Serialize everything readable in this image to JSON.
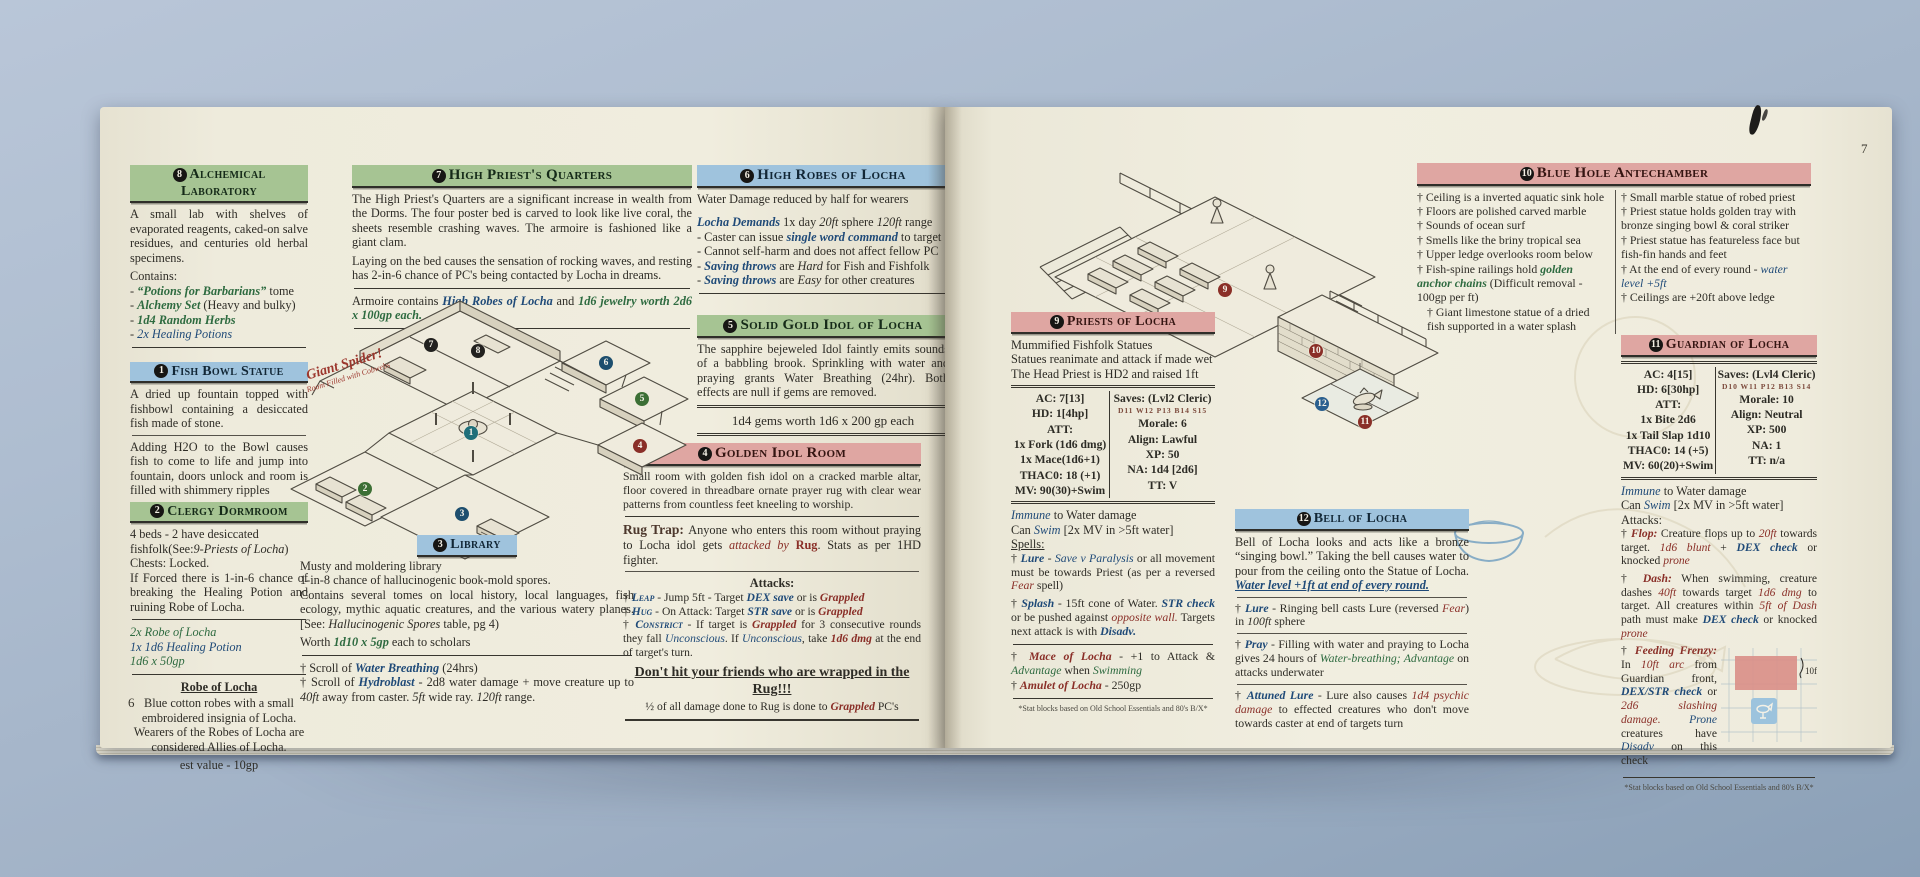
{
  "colors": {
    "header_green": "#a6c493",
    "header_blue": "#9fc3dd",
    "header_pink": "#dfa6a2",
    "accent_green": "#2e6b40",
    "accent_blue": "#1f4a78",
    "accent_red": "#8a2f28",
    "page": "#efecdd",
    "backdrop": "#a7b7cb"
  },
  "book": {
    "page6_number": "6",
    "page7_number": "7",
    "footnote": "*Stat blocks based on Old School Essentials and 80's B/X*"
  },
  "p6": {
    "alch": {
      "num": "8",
      "title": "Alchemical Laboratory",
      "body": "A small lab with shelves of evaporated reagents, caked-on salve residues, and centuries old herbal specimens.",
      "contains": "Contains:",
      "items": [
        [
          [
            "- ",
            "n"
          ],
          [
            "“Potions for Barbarians”",
            "g"
          ],
          [
            " tome",
            "n"
          ]
        ],
        [
          [
            "- ",
            "n"
          ],
          [
            "Alchemy Set",
            "g"
          ],
          [
            " (Heavy and bulky)",
            "n"
          ]
        ],
        [
          [
            "- ",
            "n"
          ],
          [
            "1d4 Random Herbs",
            "g"
          ]
        ],
        [
          [
            "- ",
            "n"
          ],
          [
            "2x Healing Potions",
            "bi"
          ]
        ]
      ]
    },
    "fish": {
      "num": "1",
      "title": "Fish Bowl Statue",
      "p1": "A dried up fountain topped with fishbowl containing a desiccated fish made of stone.",
      "p2": "Adding H2O to the Bowl causes fish to come to life and jump into fountain, doors unlock and room is filled with shimmery ripples"
    },
    "clergy": {
      "num": "2",
      "title": "Clergy Dormroom",
      "l1": [
        [
          "4 beds - 2 have desiccated fishfolk(See:",
          "n"
        ],
        [
          "9-Priests of Locha",
          "i"
        ],
        [
          ")",
          "n"
        ]
      ],
      "l2": "Chests: Locked.",
      "l3": "If Forced there is 1-in-6 chance of breaking the Healing Potion and ruining Robe of Locha.",
      "loot": [
        [
          [
            "2x Robe of Locha",
            "gi"
          ]
        ],
        [
          [
            "1x 1d6 Healing Potion",
            "bi"
          ]
        ],
        [
          [
            "1d6 x 50gp",
            "gi"
          ]
        ]
      ]
    },
    "robe": {
      "title": "Robe of Locha",
      "body": "Blue cotton robes with a small embroidered insignia of Locha. Wearers of the Robes of Locha are considered Allies of Locha.",
      "value": "est value - 10gp"
    },
    "hp": {
      "num": "7",
      "title": "High Priest's Quarters",
      "p1": "The High Priest's Quarters are a significant increase in wealth from the Dorms. The four poster bed is carved to look like live coral, the sheets resemble crashing waves. The armoire is fashioned like a giant clam.",
      "p2": "Laying on the bed causes the sensation of rocking waves, and resting has 2-in-6 chance of PC's being contacted by Locha in dreams.",
      "loot": [
        [
          "Armoire contains ",
          "n"
        ],
        [
          "High Robes of Locha",
          "b"
        ],
        [
          " and ",
          "n"
        ],
        [
          "1d6 jewelry worth 2d6 x 100gp each.",
          "g"
        ]
      ]
    },
    "robes6": {
      "num": "6",
      "title": "High Robes of Locha",
      "l1": "Water Damage reduced by half for wearers",
      "spell": [
        [
          "Locha Demands",
          "b"
        ],
        [
          " 1x day ",
          "n"
        ],
        [
          "20ft",
          "i"
        ],
        [
          " sphere ",
          "n"
        ],
        [
          "120ft",
          "i"
        ],
        [
          " range",
          "n"
        ]
      ],
      "b1": [
        [
          "- Caster can issue ",
          "n"
        ],
        [
          "single word command",
          "b"
        ],
        [
          " to target",
          "n"
        ]
      ],
      "b2": [
        [
          "- Cannot self-harm and does not affect fellow PC",
          "n"
        ]
      ],
      "b3": [
        [
          "- ",
          "n"
        ],
        [
          "Saving throws",
          "b"
        ],
        [
          " are ",
          "n"
        ],
        [
          "Hard",
          "i"
        ],
        [
          " for Fish and Fishfolk",
          "n"
        ]
      ],
      "b4": [
        [
          "- ",
          "n"
        ],
        [
          "Saving throws",
          "b"
        ],
        [
          " are ",
          "n"
        ],
        [
          "Easy",
          "i"
        ],
        [
          " for other creatures",
          "n"
        ]
      ]
    },
    "idol5": {
      "num": "5",
      "title": "Solid Gold Idol of Locha",
      "body": "The sapphire bejeweled Idol faintly emits sounds of a babbling brook.  Sprinkling with water and praying grants Water Breathing (24hr). Both effects are null if gems are removed.",
      "gems": "1d4 gems worth 1d6 x 200 gp each"
    },
    "lib": {
      "num": "3",
      "title": "Library",
      "l1": "Musty and  moldering library",
      "l2": "1-in-8 chance of hallucinogenic book-mold spores.",
      "l3": [
        [
          "Contains several tomes on local history, local languages, fish ecology, mythic aquatic creatures, and the various watery planes. [See: ",
          "n"
        ],
        [
          "Hallucinogenic Spores",
          "i"
        ],
        [
          " table, pg 4)",
          "n"
        ]
      ],
      "l4": [
        [
          "Worth ",
          "n"
        ],
        [
          "1d10 x 5gp",
          "g"
        ],
        [
          " each to scholars",
          "n"
        ]
      ],
      "s1": [
        [
          "†  Scroll of ",
          "n"
        ],
        [
          "Water Breathing",
          "b"
        ],
        [
          " (24hrs)",
          "n"
        ]
      ],
      "s2": [
        [
          "†  Scroll of ",
          "n"
        ],
        [
          "Hydroblast",
          "b"
        ],
        [
          " - 2d8 water damage + move creature up to ",
          "n"
        ],
        [
          "40ft",
          "i"
        ],
        [
          " away from caster. ",
          "n"
        ],
        [
          "5ft",
          "i"
        ],
        [
          " wide ray. ",
          "n"
        ],
        [
          "120ft",
          "i"
        ],
        [
          " range.",
          "n"
        ]
      ]
    },
    "room4": {
      "num": "4",
      "title": "Golden Idol Room",
      "body": "Small room with golden fish idol on a cracked marble altar, floor covered in threadbare ornate prayer rug with clear wear patterns from countless feet kneeling to worship.",
      "rug": [
        [
          "Rug Trap: ",
          "lbl"
        ],
        [
          "Anyone who enters this room without praying to Locha idol gets ",
          "n"
        ],
        [
          "attacked by ",
          "ri"
        ],
        [
          "Rug",
          "rb"
        ],
        [
          ". Stats as per 1HD fighter.",
          "n"
        ]
      ],
      "atk_label": "Attacks:",
      "a1": [
        [
          "†  ",
          "n"
        ],
        [
          "Leap",
          "bsc"
        ],
        [
          " - Jump 5ft - Target ",
          "n"
        ],
        [
          "DEX save",
          "b"
        ],
        [
          " or is ",
          "n"
        ],
        [
          "Grappled",
          "r"
        ]
      ],
      "a2": [
        [
          "†  ",
          "n"
        ],
        [
          "Hug",
          "bsc"
        ],
        [
          " - On Attack: Target ",
          "n"
        ],
        [
          "STR save",
          "b"
        ],
        [
          " or is ",
          "n"
        ],
        [
          "Grappled",
          "r"
        ]
      ],
      "a3": [
        [
          "†  ",
          "n"
        ],
        [
          "Constrict",
          "bsc"
        ],
        [
          " - If target is ",
          "n"
        ],
        [
          "Grappled",
          "r"
        ],
        [
          " for 3 consecutive rounds they fall ",
          "n"
        ],
        [
          "Unconscious",
          "bi"
        ],
        [
          ". If ",
          "n"
        ],
        [
          "Unconscious",
          "bi"
        ],
        [
          ", take ",
          "n"
        ],
        [
          "1d6 dmg",
          "r"
        ],
        [
          " at the end of target's turn.",
          "n"
        ]
      ],
      "dont": "Don't hit your friends who are wrapped in the Rug!!!",
      "half": [
        [
          "½ of all damage done to Rug is done to ",
          "n"
        ],
        [
          "Grappled",
          "r"
        ],
        [
          " PC's",
          "n"
        ]
      ]
    },
    "spider": {
      "l1": "Giant Spider!",
      "l2": "Room Filled with Cobwebs"
    },
    "map": {
      "markers": [
        {
          "n": "1",
          "c": "#1f6f7a",
          "x": 211,
          "y": 136
        },
        {
          "n": "2",
          "c": "#3c6f35",
          "x": 105,
          "y": 192
        },
        {
          "n": "3",
          "c": "#1d4e6e",
          "x": 202,
          "y": 217
        },
        {
          "n": "4",
          "c": "#8a2f28",
          "x": 380,
          "y": 149
        },
        {
          "n": "5",
          "c": "#3c6f35",
          "x": 382,
          "y": 102
        },
        {
          "n": "6",
          "c": "#1d4e6e",
          "x": 346,
          "y": 66
        },
        {
          "n": "7",
          "c": "#22211f",
          "x": 171,
          "y": 48
        },
        {
          "n": "8",
          "c": "#22211f",
          "x": 218,
          "y": 54
        }
      ]
    }
  },
  "p7": {
    "priests": {
      "num": "9",
      "title": "Priests of Locha",
      "d1": "Mummified Fishfolk Statues",
      "d2": "Statues reanimate and attack if made wet",
      "d3": "The Head Priest is HD2 and raised 1ft",
      "stats": {
        "left": [
          "AC: 7[13]",
          "HD: 1[4hp]",
          "ATT:",
          "1x Fork (1d6 dmg)",
          "1x Mace(1d6+1)",
          "THAC0: 18 (+1)",
          "MV: 90(30)+Swim"
        ],
        "right": [
          "Saves: (Lvl2 Cleric)",
          "D11 W12 P13 B14 S15",
          "Morale: 6",
          "Align: Lawful",
          "XP: 50",
          "NA: 1d4 [2d6]",
          "TT: V"
        ]
      },
      "ab1": [
        [
          "Immune",
          "bi"
        ],
        [
          " to Water damage",
          "n"
        ]
      ],
      "ab2": [
        [
          "Can ",
          "n"
        ],
        [
          "Swim",
          "bi"
        ],
        [
          " [2x MV in >5ft water]",
          "n"
        ]
      ],
      "spells_label": "Spells:",
      "sp1": [
        [
          "†  ",
          "n"
        ],
        [
          "Lure",
          "b"
        ],
        [
          " - ",
          "n"
        ],
        [
          "Save v Paralysis",
          "bi"
        ],
        [
          " or all movement must be towards Priest (as per a reversed ",
          "n"
        ],
        [
          "Fear",
          "ri"
        ],
        [
          " spell)",
          "n"
        ]
      ],
      "sp2": [
        [
          "†  ",
          "n"
        ],
        [
          "Splash",
          "b"
        ],
        [
          " - 15ft cone of Water. ",
          "n"
        ],
        [
          "STR check",
          "b"
        ],
        [
          " or be pushed against ",
          "n"
        ],
        [
          "opposite wall.",
          "ri"
        ],
        [
          "  Targets next attack is with ",
          "n"
        ],
        [
          "Disadv.",
          "b"
        ]
      ],
      "i1": [
        [
          "†  ",
          "n"
        ],
        [
          "Mace of Locha",
          "r"
        ],
        [
          " - +1 to Attack & ",
          "n"
        ],
        [
          "Advantage",
          "gi"
        ],
        [
          " when ",
          "n"
        ],
        [
          "Swimming",
          "gi"
        ]
      ],
      "i2": [
        [
          "†  ",
          "n"
        ],
        [
          "Amulet of Locha",
          "r"
        ],
        [
          " - 250gp",
          "n"
        ]
      ]
    },
    "bluehole": {
      "num": "10",
      "title": "Blue Hole Antechamber",
      "c1": "† Ceiling is a inverted aquatic sink hole",
      "c2": "† Floors are polished carved marble",
      "c3": "† Sounds of ocean surf",
      "c4": "† Smells like the briny tropical sea",
      "c5": "† Upper ledge overlooks room below",
      "c6": [
        [
          "† Fish-spine railings hold ",
          "n"
        ],
        [
          "golden anchor chains",
          "g"
        ],
        [
          " (Difficult removal - 100gp per ft)",
          "n"
        ]
      ],
      "c7": "†  Giant limestone statue of a dried fish supported in a water splash",
      "d1": "† Small marble statue of robed priest",
      "d2": "† Priest statue holds golden tray with bronze singing bowl & coral striker",
      "d3": "† Priest statue has featureless face but fish-fin hands and feet",
      "d4": [
        [
          "† At the end of every round - ",
          "n"
        ],
        [
          "water level +5ft",
          "bi"
        ]
      ],
      "d5": "† Ceilings are +20ft above ledge"
    },
    "guardian": {
      "num": "11",
      "title": "Guardian of Locha",
      "stats": {
        "left": [
          "AC: 4[15]",
          "HD: 6[30hp]",
          "ATT:",
          "1x Bite 2d6",
          "1x Tail Slap 1d10",
          "THAC0: 14 (+5)",
          "MV: 60(20)+Swim"
        ],
        "right": [
          "Saves: (Lvl4 Cleric)",
          "D10 W11 P12 B13 S14",
          "Morale: 10",
          "Align: Neutral",
          "XP: 500",
          "NA: 1",
          "TT: n/a"
        ]
      },
      "g1": [
        [
          "Immune",
          "bi"
        ],
        [
          " to Water damage",
          "n"
        ]
      ],
      "g2": [
        [
          "Can ",
          "n"
        ],
        [
          "Swim",
          "bi"
        ],
        [
          " [2x MV in >5ft water]",
          "n"
        ]
      ],
      "g3": "Attacks:",
      "ga1": [
        [
          "†  ",
          "n"
        ],
        [
          "Flop:",
          "r"
        ],
        [
          " Creature flops up to ",
          "n"
        ],
        [
          "20ft",
          "ri"
        ],
        [
          " towards target. ",
          "n"
        ],
        [
          "1d6 blunt",
          "ri"
        ],
        [
          " + ",
          "n"
        ],
        [
          "DEX check",
          "b"
        ],
        [
          " or knocked ",
          "n"
        ],
        [
          "prone",
          "ri"
        ]
      ],
      "ga2": [
        [
          "†  ",
          "n"
        ],
        [
          "Dash:",
          "r"
        ],
        [
          " When swimming, creature dashes ",
          "n"
        ],
        [
          "40ft",
          "ri"
        ],
        [
          " towards target ",
          "n"
        ],
        [
          "1d6 dmg",
          "ri"
        ],
        [
          " to target. All creatures within ",
          "n"
        ],
        [
          "5ft of Dash",
          "ri"
        ],
        [
          " path must make ",
          "n"
        ],
        [
          "DEX check",
          "b"
        ],
        [
          " or knocked ",
          "n"
        ],
        [
          "prone",
          "ri"
        ]
      ],
      "ga3": [
        [
          "†  ",
          "n"
        ],
        [
          "Feeding Frenzy:",
          "r"
        ],
        [
          " In ",
          "n"
        ],
        [
          "10ft arc",
          "ri"
        ],
        [
          " from Guardian front, ",
          "n"
        ],
        [
          "DEX/STR check",
          "b"
        ],
        [
          " or ",
          "n"
        ],
        [
          "2d6 slashing damage.",
          "ri"
        ],
        [
          " ",
          "n"
        ],
        [
          "Prone",
          "bi"
        ],
        [
          " creatures have ",
          "n"
        ],
        [
          "Disadv",
          "bi"
        ],
        [
          " on this check",
          "n"
        ]
      ],
      "diagram_label": "10ft"
    },
    "bell": {
      "num": "12",
      "title": "Bell of Locha",
      "body": [
        [
          "Bell of Locha looks and acts like a bronze “singing bowl.” Taking the bell causes water to pour from the ceiling onto the Statue of Locha. ",
          "n"
        ],
        [
          "Water level +1ft at end of every round.",
          "u"
        ]
      ],
      "b1": [
        [
          "†  ",
          "n"
        ],
        [
          "Lure",
          "b"
        ],
        [
          " - Ringing bell casts Lure (reversed ",
          "n"
        ],
        [
          "Fear",
          "ri"
        ],
        [
          ") in ",
          "n"
        ],
        [
          "100ft",
          "i"
        ],
        [
          " sphere",
          "n"
        ]
      ],
      "b2": [
        [
          "†  ",
          "n"
        ],
        [
          "Pray",
          "b"
        ],
        [
          " - Filling with water and praying to Locha gives 24 hours of ",
          "n"
        ],
        [
          "Water-breathing;",
          "gi"
        ],
        [
          " ",
          "n"
        ],
        [
          "Advantage",
          "gi"
        ],
        [
          " on attacks underwater",
          "n"
        ]
      ],
      "b3": [
        [
          "†  ",
          "n"
        ],
        [
          "Attuned Lure",
          "b"
        ],
        [
          " - Lure also causes ",
          "n"
        ],
        [
          "1d4 psychic damage",
          "ri"
        ],
        [
          " to effected creatures who don't move towards caster at end of targets turn",
          "n"
        ]
      ]
    },
    "map": {
      "markers": [
        {
          "n": "9",
          "c": "#8a2f28",
          "x": 255,
          "y": 143
        },
        {
          "n": "10",
          "c": "#8a2f28",
          "x": 346,
          "y": 204
        },
        {
          "n": "11",
          "c": "#8a2f28",
          "x": 395,
          "y": 275
        },
        {
          "n": "12",
          "c": "#2a5f8f",
          "x": 352,
          "y": 257
        }
      ]
    }
  }
}
